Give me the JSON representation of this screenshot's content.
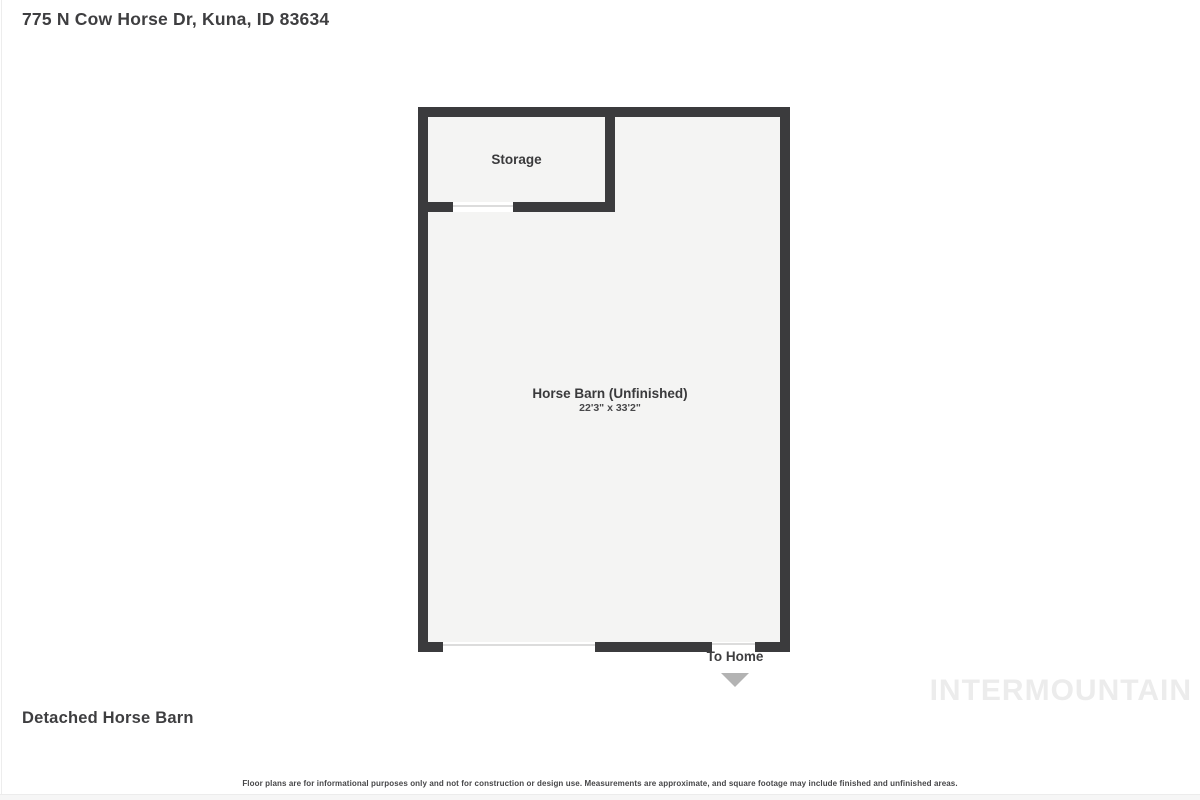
{
  "page": {
    "address": "775 N Cow Horse Dr, Kuna, ID 83634",
    "plan_title": "Detached Horse Barn",
    "watermark": "INTERMOUNTAIN",
    "disclaimer": "Floor plans are for informational purposes only and not for construction or design use. Measurements are approximate, and square footage may include finished and unfinished areas."
  },
  "floorplan": {
    "rooms": [
      {
        "label": "Storage"
      },
      {
        "label": "Horse Barn (Unfinished)",
        "dimensions": "22'3\" x 33'2\""
      }
    ],
    "openings": [
      {
        "name": "garage-door-opening",
        "wall": "bottom"
      },
      {
        "name": "to-home-door-opening",
        "wall": "bottom"
      },
      {
        "name": "storage-door-opening",
        "wall": "storage-bottom"
      }
    ],
    "exit_label": "To Home",
    "colors": {
      "wall": "#3b3b3d",
      "room_fill": "#f4f4f3",
      "arrow": "#b3b3b3",
      "text": "#3e3e40",
      "watermark": "#ececec"
    }
  }
}
